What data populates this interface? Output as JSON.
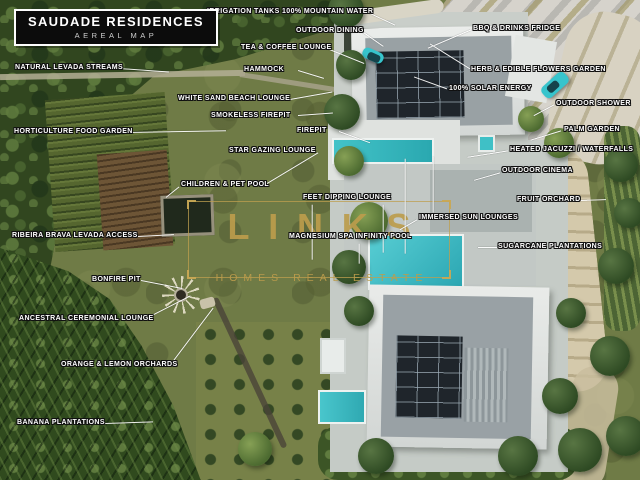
{
  "header": {
    "title": "SAUDADE RESIDENCES",
    "subtitle": "AEREAL MAP"
  },
  "watermark": {
    "brand": "LINKS",
    "tagline": "HOMES REAL ESTATE"
  },
  "colors": {
    "accent_gold": "#bc9c4c",
    "pool_teal": "#3ec1c6",
    "label_text": "#ffffff",
    "label_outline": "#101010",
    "title_background": "#0c0c0c"
  },
  "labels": [
    {
      "id": "irrigation-tanks",
      "text": "IRRIGATION TANKS 100% MOUNTAIN WATER"
    },
    {
      "id": "outdoor-dining",
      "text": "OUTDOOR DINING"
    },
    {
      "id": "bbq-drinks-fridge",
      "text": "BBQ & DRINKS FRIDGE"
    },
    {
      "id": "tea-coffee-lounge",
      "text": "TEA & COFFEE LOUNGE"
    },
    {
      "id": "natural-levada-streams",
      "text": "NATURAL LEVADA STREAMS"
    },
    {
      "id": "hammock",
      "text": "HAMMOCK"
    },
    {
      "id": "herb-edible-flowers-garden",
      "text": "HERB & EDIBLE FLOWERS GARDEN"
    },
    {
      "id": "solar-energy",
      "text": "100% SOLAR ENERGY"
    },
    {
      "id": "white-sand-beach-lounge",
      "text": "WHITE SAND BEACH LOUNGE"
    },
    {
      "id": "outdoor-shower",
      "text": "OUTDOOR SHOWER"
    },
    {
      "id": "smokeless-firepit",
      "text": "SMOKELESS FIREPIT"
    },
    {
      "id": "horticulture-food-garden",
      "text": "HORTICULTURE FOOD GARDEN"
    },
    {
      "id": "firepit",
      "text": "FIREPIT"
    },
    {
      "id": "palm-garden",
      "text": "PALM GARDEN"
    },
    {
      "id": "star-gazing-lounge",
      "text": "STAR GAZING LOUNGE"
    },
    {
      "id": "heated-jacuzzi-waterfalls",
      "text": "HEATED JACUZZI / WATERFALLS"
    },
    {
      "id": "outdoor-cinema",
      "text": "OUTDOOR CINEMA"
    },
    {
      "id": "children-pet-pool",
      "text": "CHILDREN & PET POOL"
    },
    {
      "id": "feet-dipping-lounge",
      "text": "FEET DIPPING LOUNGE"
    },
    {
      "id": "fruit-orchard",
      "text": "FRUIT ORCHARD"
    },
    {
      "id": "immersed-sun-lounges",
      "text": "IMMERSED SUN LOUNGES"
    },
    {
      "id": "ribeira-brava-levada-access",
      "text": "RIBEIRA BRAVA LEVADA ACCESS"
    },
    {
      "id": "magnesium-spa-infinity-pool",
      "text": "MAGNESIUM SPA INFINITY POOL"
    },
    {
      "id": "sugarcane-plantations",
      "text": "SUGARCANE PLANTATIONS"
    },
    {
      "id": "bonfire-pit",
      "text": "BONFIRE PIT"
    },
    {
      "id": "ancestral-ceremonial-lounge",
      "text": "ANCESTRAL CEREMONIAL LOUNGE"
    },
    {
      "id": "orange-lemon-orchards",
      "text": "ORANGE & LEMON ORCHARDS"
    },
    {
      "id": "banana-plantations",
      "text": "BANANA PLANTATIONS"
    }
  ]
}
